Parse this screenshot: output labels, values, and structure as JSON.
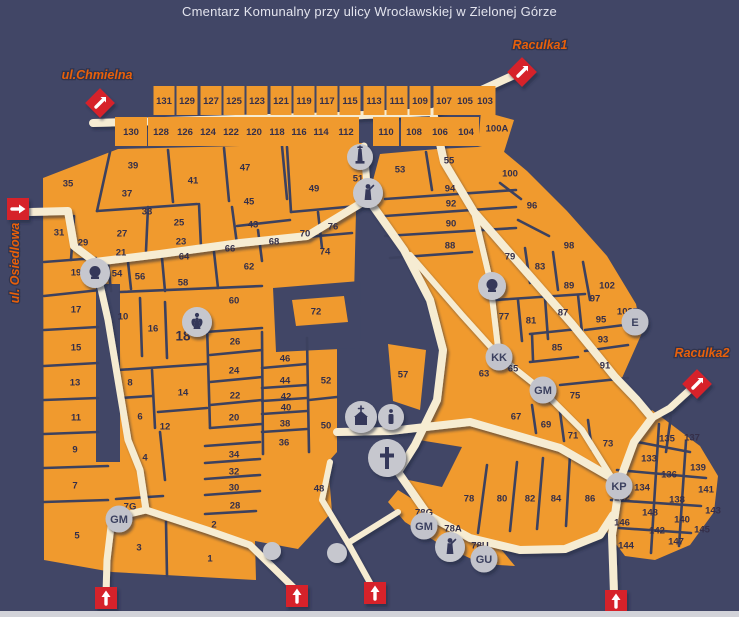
{
  "title": "Cmentarz Komunalny przy ulicy Wrocławskiej w Zielonej Górze",
  "colors": {
    "background": "#414666",
    "land": "#F09A2E",
    "road": "#F6ECD2",
    "border": "#3C415F",
    "section_label": "#352F49",
    "marker_red": "#D6202A",
    "circle_gray": "#C2C3CB",
    "street_label": "#E8600A",
    "title_text": "#E3E4EE"
  },
  "streets": [
    {
      "name": "chmielna-street-label",
      "label": "ul.Chmielna",
      "x": 97,
      "y": 79,
      "rotate": 0
    },
    {
      "name": "raculka1-street-label",
      "label": "Raculka1",
      "x": 540,
      "y": 49,
      "rotate": 0
    },
    {
      "name": "raculka2-street-label",
      "label": "Raculka2",
      "x": 702,
      "y": 357,
      "rotate": 0
    },
    {
      "name": "osiedlowa-street-label",
      "label": "ul. Osiedlowa",
      "x": 19,
      "y": 263,
      "rotate": -90
    }
  ],
  "entrances": [
    {
      "name": "chmielna-entrance",
      "shape": "diamond",
      "x": 100,
      "y": 103,
      "dir": "ne"
    },
    {
      "name": "raculka1-entrance",
      "shape": "diamond",
      "x": 522,
      "y": 72,
      "dir": "ne"
    },
    {
      "name": "raculka2-entrance",
      "shape": "diamond",
      "x": 697,
      "y": 384,
      "dir": "ne"
    },
    {
      "name": "osiedlowa-entrance",
      "shape": "square",
      "x": 18,
      "y": 209,
      "dir": "right"
    },
    {
      "name": "south-entrance-1",
      "shape": "square",
      "x": 106,
      "y": 598,
      "dir": "up"
    },
    {
      "name": "south-entrance-2",
      "shape": "square",
      "x": 297,
      "y": 596,
      "dir": "up"
    },
    {
      "name": "south-entrance-3",
      "shape": "square",
      "x": 375,
      "y": 593,
      "dir": "up"
    },
    {
      "name": "south-entrance-4",
      "shape": "square",
      "x": 616,
      "y": 601,
      "dir": "up"
    }
  ],
  "top_rows": {
    "upper": {
      "labels": [
        "131",
        "129",
        "127",
        "125",
        "123",
        "121",
        "119",
        "117",
        "115",
        "113",
        "111",
        "109",
        "107",
        "105",
        "103"
      ],
      "centers": [
        164,
        187,
        211,
        234,
        257,
        281,
        304,
        327,
        350,
        374,
        397,
        420,
        444,
        465,
        485
      ],
      "y_rect": 86,
      "label_y": 101,
      "cell_w": 21,
      "cell_h": 29
    },
    "lower": {
      "labels": [
        "130",
        "128",
        "126",
        "124",
        "122",
        "120",
        "118",
        "116",
        "114",
        "112",
        "110",
        "108",
        "106",
        "104"
      ],
      "centers": [
        131,
        161,
        185,
        208,
        231,
        254,
        277,
        299,
        321,
        346,
        386,
        414,
        440,
        466
      ],
      "y_rect": 117,
      "label_y": 132,
      "cell_w": 26,
      "cell_h": 29
    }
  },
  "sections": [
    {
      "l": "35",
      "x": 68,
      "y": 183
    },
    {
      "l": "39",
      "x": 133,
      "y": 165
    },
    {
      "l": "37",
      "x": 127,
      "y": 193
    },
    {
      "l": "41",
      "x": 193,
      "y": 180
    },
    {
      "l": "47",
      "x": 245,
      "y": 167
    },
    {
      "l": "45",
      "x": 249,
      "y": 201
    },
    {
      "l": "43",
      "x": 253,
      "y": 224
    },
    {
      "l": "49",
      "x": 314,
      "y": 188
    },
    {
      "l": "51",
      "x": 358,
      "y": 178
    },
    {
      "l": "53",
      "x": 400,
      "y": 169
    },
    {
      "l": "55",
      "x": 449,
      "y": 160
    },
    {
      "l": "33",
      "x": 147,
      "y": 211
    },
    {
      "l": "25",
      "x": 179,
      "y": 222
    },
    {
      "l": "23",
      "x": 181,
      "y": 241
    },
    {
      "l": "27",
      "x": 122,
      "y": 233
    },
    {
      "l": "21",
      "x": 121,
      "y": 252
    },
    {
      "l": "31",
      "x": 59,
      "y": 232
    },
    {
      "l": "29",
      "x": 83,
      "y": 242
    },
    {
      "l": "19",
      "x": 76,
      "y": 272
    },
    {
      "l": "54",
      "x": 117,
      "y": 273
    },
    {
      "l": "56",
      "x": 140,
      "y": 276
    },
    {
      "l": "58",
      "x": 183,
      "y": 282
    },
    {
      "l": "64",
      "x": 184,
      "y": 256
    },
    {
      "l": "66",
      "x": 230,
      "y": 248
    },
    {
      "l": "68",
      "x": 274,
      "y": 241
    },
    {
      "l": "70",
      "x": 305,
      "y": 233
    },
    {
      "l": "76",
      "x": 333,
      "y": 226
    },
    {
      "l": "74",
      "x": 325,
      "y": 251
    },
    {
      "l": "62",
      "x": 249,
      "y": 266
    },
    {
      "l": "60",
      "x": 234,
      "y": 300
    },
    {
      "l": "17",
      "x": 76,
      "y": 309
    },
    {
      "l": "15",
      "x": 76,
      "y": 347
    },
    {
      "l": "13",
      "x": 75,
      "y": 382
    },
    {
      "l": "11",
      "x": 76,
      "y": 417
    },
    {
      "l": "9",
      "x": 75,
      "y": 449
    },
    {
      "l": "7",
      "x": 75,
      "y": 485
    },
    {
      "l": "5",
      "x": 77,
      "y": 535
    },
    {
      "l": "10",
      "x": 123,
      "y": 316
    },
    {
      "l": "16",
      "x": 153,
      "y": 328
    },
    {
      "l": "18",
      "x": 183,
      "y": 337,
      "big": true
    },
    {
      "l": "8",
      "x": 130,
      "y": 382
    },
    {
      "l": "6",
      "x": 140,
      "y": 416
    },
    {
      "l": "14",
      "x": 183,
      "y": 392
    },
    {
      "l": "12",
      "x": 165,
      "y": 426
    },
    {
      "l": "26",
      "x": 235,
      "y": 341
    },
    {
      "l": "24",
      "x": 234,
      "y": 370
    },
    {
      "l": "22",
      "x": 235,
      "y": 395
    },
    {
      "l": "20",
      "x": 234,
      "y": 417
    },
    {
      "l": "46",
      "x": 285,
      "y": 358
    },
    {
      "l": "44",
      "x": 285,
      "y": 380
    },
    {
      "l": "42",
      "x": 286,
      "y": 396
    },
    {
      "l": "40",
      "x": 286,
      "y": 407
    },
    {
      "l": "38",
      "x": 285,
      "y": 423
    },
    {
      "l": "36",
      "x": 284,
      "y": 442
    },
    {
      "l": "34",
      "x": 234,
      "y": 454
    },
    {
      "l": "32",
      "x": 234,
      "y": 471
    },
    {
      "l": "30",
      "x": 234,
      "y": 487
    },
    {
      "l": "28",
      "x": 235,
      "y": 505
    },
    {
      "l": "2",
      "x": 214,
      "y": 524
    },
    {
      "l": "1",
      "x": 210,
      "y": 558
    },
    {
      "l": "3",
      "x": 139,
      "y": 547
    },
    {
      "l": "4",
      "x": 145,
      "y": 457
    },
    {
      "l": "7G",
      "x": 130,
      "y": 506
    },
    {
      "l": "52",
      "x": 326,
      "y": 380
    },
    {
      "l": "50",
      "x": 326,
      "y": 425
    },
    {
      "l": "48",
      "x": 319,
      "y": 488
    },
    {
      "l": "72",
      "x": 316,
      "y": 311
    },
    {
      "l": "57",
      "x": 403,
      "y": 374
    },
    {
      "l": "94",
      "x": 450,
      "y": 188
    },
    {
      "l": "92",
      "x": 451,
      "y": 203
    },
    {
      "l": "90",
      "x": 451,
      "y": 223
    },
    {
      "l": "88",
      "x": 450,
      "y": 245
    },
    {
      "l": "100",
      "x": 510,
      "y": 173
    },
    {
      "l": "96",
      "x": 532,
      "y": 205
    },
    {
      "l": "98",
      "x": 569,
      "y": 245
    },
    {
      "l": "79",
      "x": 510,
      "y": 256
    },
    {
      "l": "83",
      "x": 540,
      "y": 266
    },
    {
      "l": "89",
      "x": 569,
      "y": 285
    },
    {
      "l": "102",
      "x": 607,
      "y": 285
    },
    {
      "l": "97",
      "x": 595,
      "y": 298
    },
    {
      "l": "102E",
      "x": 628,
      "y": 311
    },
    {
      "l": "77",
      "x": 504,
      "y": 316
    },
    {
      "l": "81",
      "x": 531,
      "y": 320
    },
    {
      "l": "87",
      "x": 563,
      "y": 312
    },
    {
      "l": "95",
      "x": 601,
      "y": 319
    },
    {
      "l": "93",
      "x": 603,
      "y": 339
    },
    {
      "l": "85",
      "x": 557,
      "y": 347
    },
    {
      "l": "91",
      "x": 605,
      "y": 365
    },
    {
      "l": "65",
      "x": 513,
      "y": 368
    },
    {
      "l": "63",
      "x": 484,
      "y": 373
    },
    {
      "l": "75",
      "x": 575,
      "y": 395
    },
    {
      "l": "67",
      "x": 516,
      "y": 416
    },
    {
      "l": "69",
      "x": 546,
      "y": 424
    },
    {
      "l": "71",
      "x": 573,
      "y": 435
    },
    {
      "l": "73",
      "x": 608,
      "y": 443
    },
    {
      "l": "78",
      "x": 469,
      "y": 498
    },
    {
      "l": "80",
      "x": 502,
      "y": 498
    },
    {
      "l": "82",
      "x": 530,
      "y": 498
    },
    {
      "l": "84",
      "x": 556,
      "y": 498
    },
    {
      "l": "86",
      "x": 590,
      "y": 498
    },
    {
      "l": "78G",
      "x": 424,
      "y": 512
    },
    {
      "l": "78A",
      "x": 453,
      "y": 528
    },
    {
      "l": "78U",
      "x": 480,
      "y": 545
    },
    {
      "l": "132",
      "x": 622,
      "y": 497
    },
    {
      "l": "100A",
      "x": 497,
      "y": 128
    },
    {
      "l": "135",
      "x": 667,
      "y": 438
    },
    {
      "l": "137",
      "x": 692,
      "y": 437
    },
    {
      "l": "133",
      "x": 649,
      "y": 458
    },
    {
      "l": "139",
      "x": 698,
      "y": 467
    },
    {
      "l": "136",
      "x": 669,
      "y": 474
    },
    {
      "l": "134",
      "x": 642,
      "y": 487
    },
    {
      "l": "141",
      "x": 706,
      "y": 489
    },
    {
      "l": "138",
      "x": 677,
      "y": 499
    },
    {
      "l": "148",
      "x": 650,
      "y": 512
    },
    {
      "l": "143",
      "x": 713,
      "y": 510
    },
    {
      "l": "146",
      "x": 622,
      "y": 522
    },
    {
      "l": "140",
      "x": 682,
      "y": 519
    },
    {
      "l": "142",
      "x": 657,
      "y": 530
    },
    {
      "l": "145",
      "x": 702,
      "y": 529
    },
    {
      "l": "144",
      "x": 626,
      "y": 545
    },
    {
      "l": "147",
      "x": 676,
      "y": 541
    }
  ],
  "badges": [
    {
      "name": "kk-badge",
      "label": "KK",
      "x": 499,
      "y": 357
    },
    {
      "name": "gm-badge",
      "label": "GM",
      "x": 543,
      "y": 390
    },
    {
      "name": "gm-badge",
      "label": "GM",
      "x": 119,
      "y": 519
    },
    {
      "name": "gm-badge",
      "label": "GM",
      "x": 424,
      "y": 526
    },
    {
      "name": "gu-badge",
      "label": "GU",
      "x": 484,
      "y": 559
    },
    {
      "name": "kp-badge",
      "label": "KP",
      "x": 619,
      "y": 486
    },
    {
      "name": "e-badge",
      "label": "E",
      "x": 635,
      "y": 322
    }
  ],
  "icons": [
    {
      "name": "obelisk-icon",
      "type": "obelisk",
      "x": 360,
      "y": 157,
      "r": 13
    },
    {
      "name": "statue-icon",
      "type": "statue",
      "x": 368,
      "y": 193,
      "r": 15
    },
    {
      "name": "bust-icon",
      "type": "bust",
      "x": 95,
      "y": 273,
      "r": 15
    },
    {
      "name": "angel-icon",
      "type": "angel",
      "x": 197,
      "y": 322,
      "r": 15
    },
    {
      "name": "chapel-icon",
      "type": "chapel",
      "x": 361,
      "y": 417,
      "r": 16
    },
    {
      "name": "candle-icon",
      "type": "candle",
      "x": 391,
      "y": 417,
      "r": 13
    },
    {
      "name": "cross-icon",
      "type": "cross",
      "x": 387,
      "y": 458,
      "r": 19
    },
    {
      "name": "obelisk-dark-icon",
      "type": "bust",
      "x": 492,
      "y": 286,
      "r": 14
    },
    {
      "name": "statue-icon",
      "type": "statue",
      "x": 450,
      "y": 547,
      "r": 15
    },
    {
      "name": "dot-icon",
      "type": "dot",
      "x": 272,
      "y": 551,
      "r": 9
    },
    {
      "name": "dot-icon",
      "type": "dot",
      "x": 337,
      "y": 553,
      "r": 10
    }
  ]
}
